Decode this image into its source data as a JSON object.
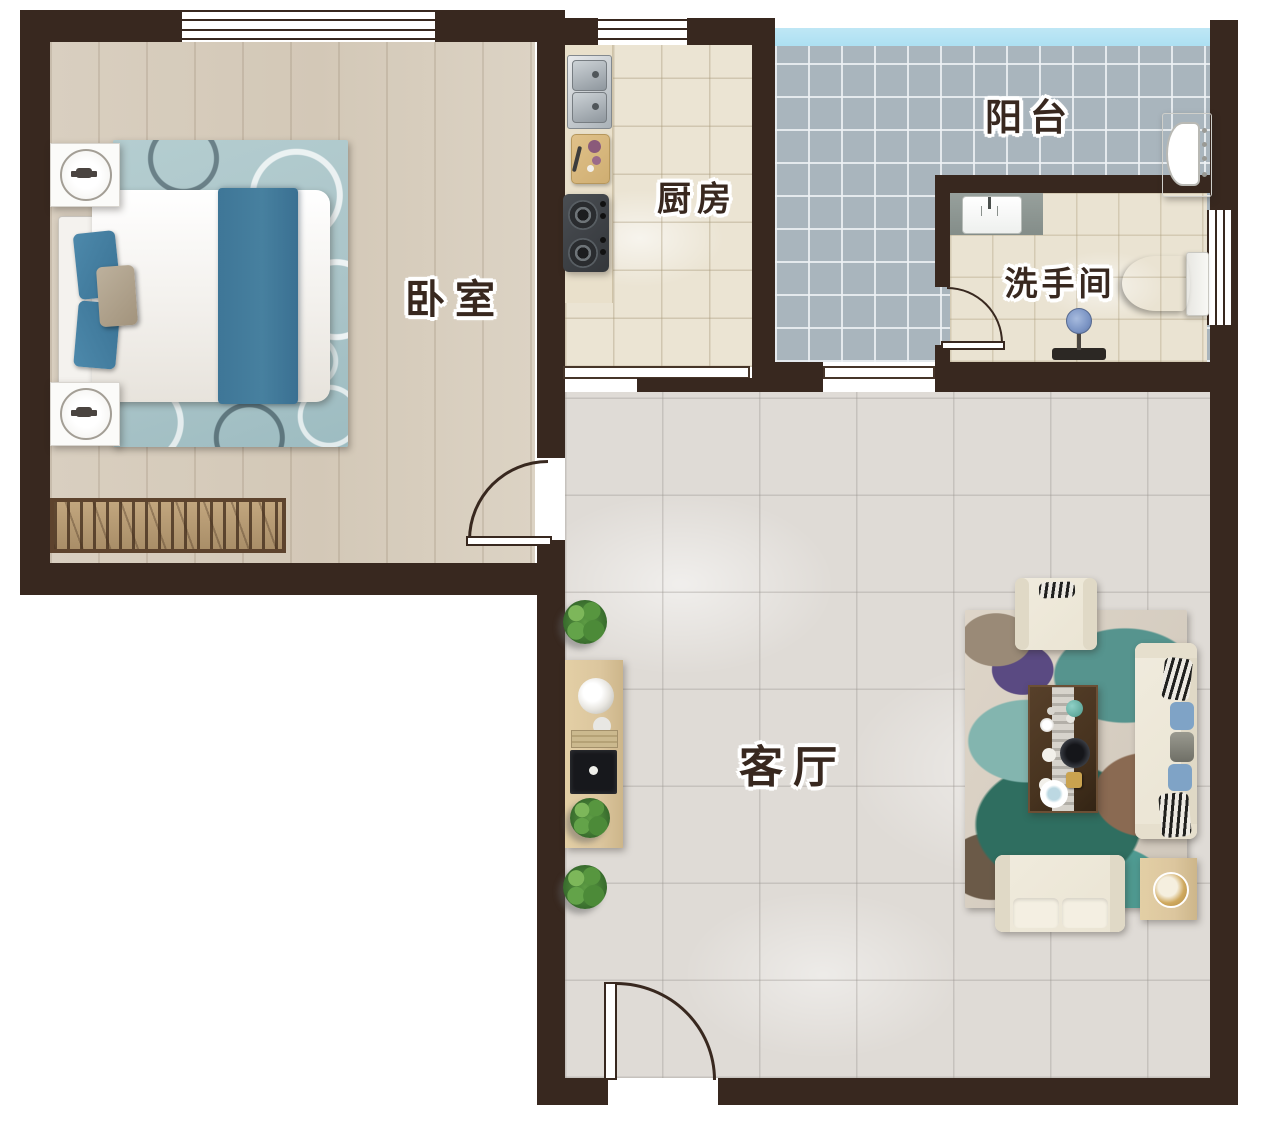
{
  "plan": {
    "type": "apartment-floor-plan",
    "rooms": {
      "bedroom": {
        "label": "卧室",
        "furniture": [
          "double-bed",
          "bedside-table-lamp",
          "bedside-table-lamp",
          "circle-pattern-rug",
          "radiator"
        ]
      },
      "kitchen": {
        "label": "厨房",
        "furniture": [
          "double-basin-sink",
          "cutting-board",
          "gas-stove",
          "counter"
        ]
      },
      "balcony": {
        "label": "阳台",
        "furniture": [
          "washing-machine",
          "glass-railing"
        ]
      },
      "bathroom": {
        "label": "洗手间",
        "furniture": [
          "washbasin",
          "toilet",
          "shower"
        ]
      },
      "living_room": {
        "label": "客厅",
        "furniture": [
          "three-seat-sofa",
          "armchair",
          "loveseat",
          "coffee-table-tea-set",
          "tv-console",
          "side-table",
          "abstract-rug",
          "potted-plants"
        ]
      }
    }
  },
  "colors": {
    "wall": "#38281f",
    "label-text": "#38281f",
    "bedroom-floor": "#d9cfc0",
    "kitchen-floor": "#ebe4d3",
    "bathroom-floor": "#eae3d2",
    "balcony-floor": "#a9b5bd",
    "balcony-glass": "#ade0f2",
    "living-floor": "#dfdbd6",
    "bed-accent": "#47809f",
    "bedroom-rug": "#aac4c8",
    "living-rug": "#5a9e96",
    "sofa": "#eae4d3",
    "wood": "#dcc69e",
    "coffee-table": "#47331f"
  }
}
